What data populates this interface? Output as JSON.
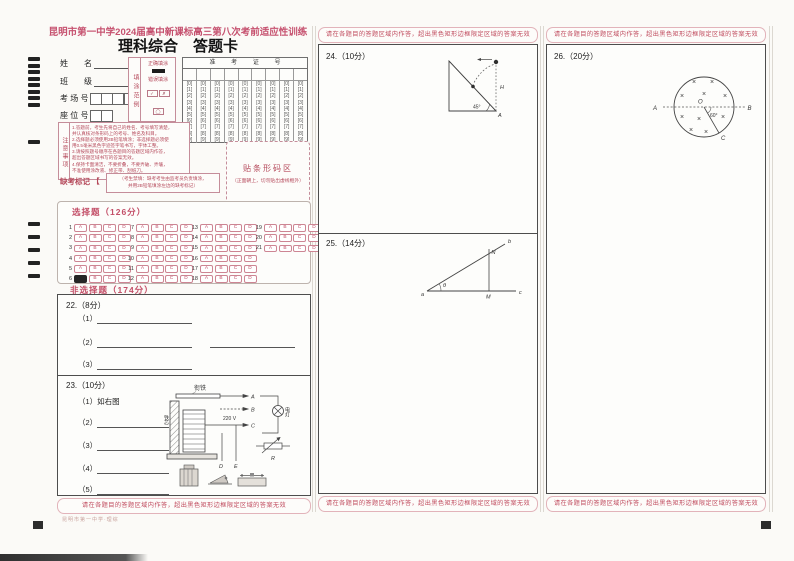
{
  "header": {
    "title": "昆明市第一中学2024届高中新课标高三第八次考前适应性训练",
    "subtitle": "理科综合　答题卡"
  },
  "fields": {
    "name": "姓　　名",
    "clazz": "班　　级",
    "room": "考 场 号",
    "seat": "座 位 号",
    "room_boxes": 4,
    "seat_boxes": 2
  },
  "fill_example": {
    "vertical": "填涂范例",
    "correct": "正确填涂",
    "wrong": "错误填涂",
    "wrong_marks": [
      [
        "✓",
        "✗",
        "◯"
      ],
      [
        "●",
        "❘",
        "▭"
      ]
    ]
  },
  "ticket": {
    "header": "准 考 证 号",
    "columns": 9,
    "digits": [
      "0",
      "1",
      "2",
      "3",
      "4",
      "5",
      "6",
      "7",
      "8",
      "9"
    ]
  },
  "notice": {
    "vertical": "注意事项",
    "lines": [
      "1.答题前，考生先将自己的姓名、考号填写清楚，",
      "并认真核对条形码上的考号、姓名及科目。",
      "2.选择题必须使用2B铅笔填涂；非选择题必须使",
      "用0.5毫米黑色字迹签字笔书写，字体工整。",
      "3.请按照题号顺序在各题目的答题区域内作答，",
      "超出答题区域书写的答案无效。",
      "4.保持卡面清洁，不要折叠，不要弄破、弄皱，",
      "不准使用涂改液、修正带、刮纸刀。"
    ]
  },
  "absent": {
    "label": "缺考标记",
    "bracket": "【　】",
    "note1": "（考生禁填：缺考考生由监考员负责填涂，",
    "note2": "并用2B铅笔填涂左边的缺考标记）"
  },
  "barcode": {
    "title": "贴条形码区",
    "subtitle": "（正面朝上，切勿贴出虚线框外）"
  },
  "warning": "请在各题目的答题区域内作答，超出黑色矩形边框限定区域的答案无效",
  "mcq": {
    "title": "选择题（126分）",
    "options": [
      "A",
      "B",
      "C",
      "D"
    ],
    "groups": [
      {
        "start": 1,
        "end": 6
      },
      {
        "start": 7,
        "end": 12
      },
      {
        "start": 13,
        "end": 18
      },
      {
        "start": 19,
        "end": 21
      }
    ],
    "filled": [
      [
        6,
        "A"
      ]
    ]
  },
  "frq": {
    "title": "非选择题（174分）",
    "q22": {
      "label": "22.（8分）",
      "items": [
        "（1）",
        "（2）",
        "（3）"
      ]
    },
    "q23": {
      "label": "23.（10分）",
      "item1": "（1）如右图",
      "items": [
        "（2）",
        "（3）",
        "（4）",
        "（5）"
      ]
    }
  },
  "q23_diagram": {
    "armature": "衔铁",
    "core": "铁芯",
    "voltage": "220 V",
    "t_a": "A",
    "t_b": "B",
    "t_c": "C",
    "t_d": "D",
    "t_e": "E",
    "lamp": "电灯",
    "resistor": "R"
  },
  "q24": {
    "label": "24.（10分）",
    "angle": "45°",
    "height": "H",
    "vertex": "A"
  },
  "q25": {
    "label": "25.（14分）",
    "pa": "a",
    "pb": "b",
    "pc": "c",
    "pm": "M",
    "pn": "N",
    "theta": "θ"
  },
  "q26": {
    "label": "26.（20分）",
    "pa": "A",
    "pb": "B",
    "pc": "C",
    "po": "O",
    "angle": "60°",
    "field_symbol": "×"
  },
  "footer": {
    "note": "昆明市第一中学·理综"
  },
  "colors": {
    "accent_pink": "#c6516f",
    "notice_red": "#b5495b",
    "warning_red": "#c04b5e",
    "ink": "#222222"
  }
}
